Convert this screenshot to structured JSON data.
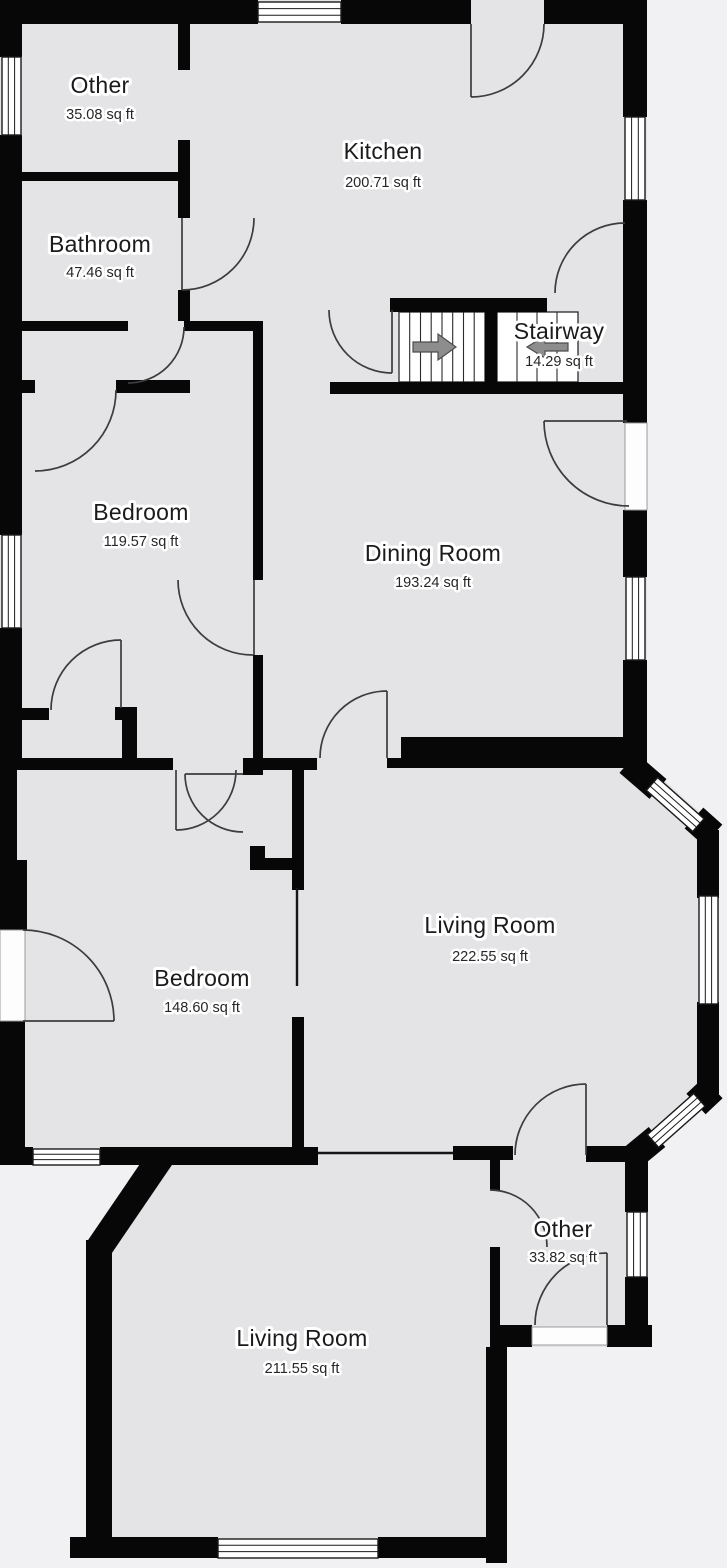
{
  "title": "Floor Plan",
  "colors": {
    "bg": "#f1f0f3",
    "floor": "#e4e3e6",
    "wall": "#070707",
    "line": "#3c3c3c",
    "arrow": "#8d8d8d",
    "text": "#1b1b1b"
  },
  "rooms": [
    {
      "id": "other-1",
      "name": "Other",
      "area": "35.08 sq ft"
    },
    {
      "id": "kitchen",
      "name": "Kitchen",
      "area": "200.71 sq ft"
    },
    {
      "id": "bathroom",
      "name": "Bathroom",
      "area": "47.46 sq ft"
    },
    {
      "id": "stairway",
      "name": "Stairway",
      "area": "14.29 sq ft"
    },
    {
      "id": "bedroom-1",
      "name": "Bedroom",
      "area": "119.57 sq ft"
    },
    {
      "id": "dining-room",
      "name": "Dining Room",
      "area": "193.24 sq ft"
    },
    {
      "id": "bedroom-2",
      "name": "Bedroom",
      "area": "148.60 sq ft"
    },
    {
      "id": "living-room-1",
      "name": "Living Room",
      "area": "222.55 sq ft"
    },
    {
      "id": "other-2",
      "name": "Other",
      "area": "33.82 sq ft"
    },
    {
      "id": "living-room-2",
      "name": "Living Room",
      "area": "211.55 sq ft"
    }
  ],
  "stairway": {
    "icons": [
      "arrow-right-icon",
      "arrow-left-icon"
    ],
    "flights": 2
  }
}
